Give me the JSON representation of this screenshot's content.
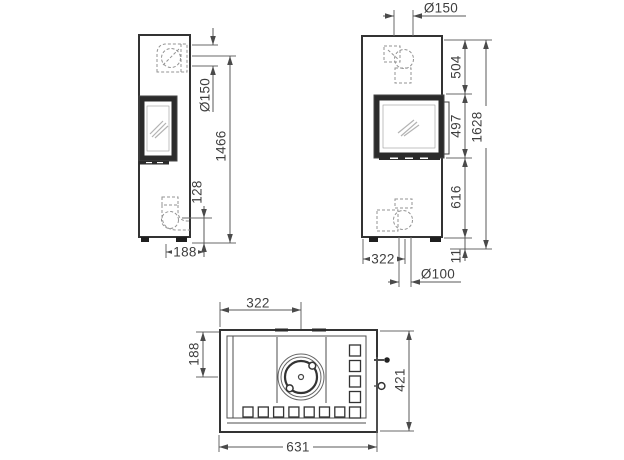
{
  "drawing": {
    "side_view": {
      "dims": {
        "flue_diameter": "Ø150",
        "flue_outlet_height": "1466",
        "air_inlet_height": "128",
        "outlet_depth": "188"
      }
    },
    "front_view": {
      "dims": {
        "flue_diameter": "Ø150",
        "top_to_window": "504",
        "window_height": "497",
        "window_to_base": "616",
        "total_height": "1628",
        "base_height": "11",
        "outlet_offset": "322",
        "air_inlet_diameter": "Ø100"
      }
    },
    "top_view": {
      "dims": {
        "flue_offset_x": "322",
        "flue_offset_y": "188",
        "depth": "421",
        "width": "631"
      }
    }
  }
}
